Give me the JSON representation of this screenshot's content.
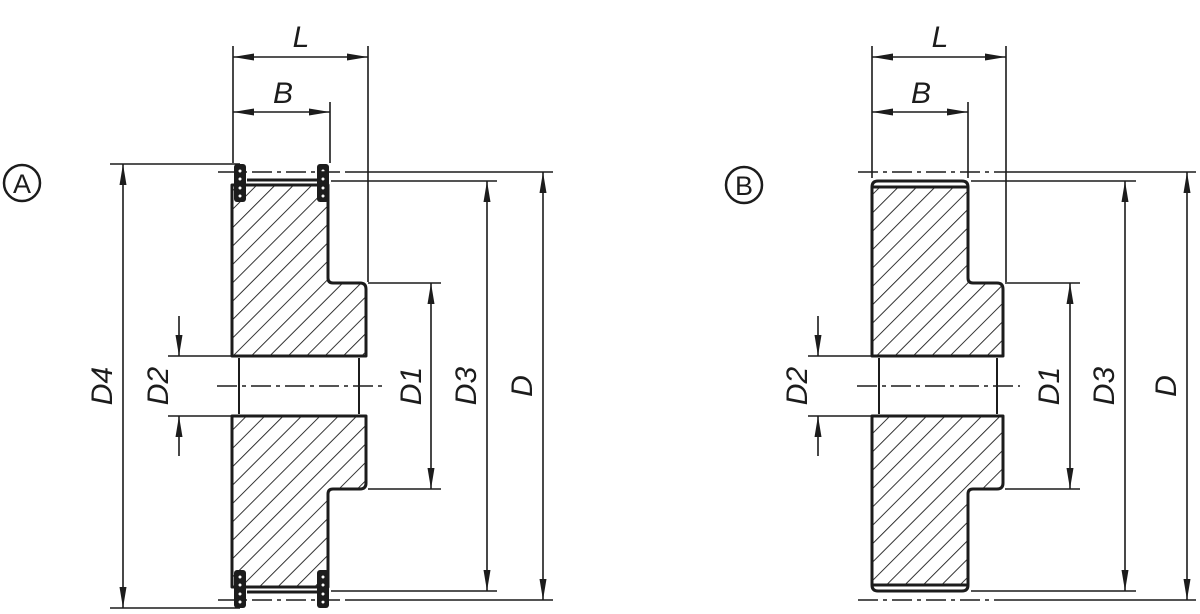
{
  "drawing": {
    "background": "#ffffff",
    "line_color": "#1c1c1c",
    "views": [
      {
        "badge": "A",
        "dims": {
          "L": "L",
          "B": "B",
          "D": "D",
          "D1": "D1",
          "D2": "D2",
          "D3": "D3",
          "D4": "D4"
        }
      },
      {
        "badge": "B",
        "dims": {
          "L": "L",
          "B": "B",
          "D": "D",
          "D1": "D1",
          "D2": "D2",
          "D3": "D3"
        }
      }
    ]
  }
}
